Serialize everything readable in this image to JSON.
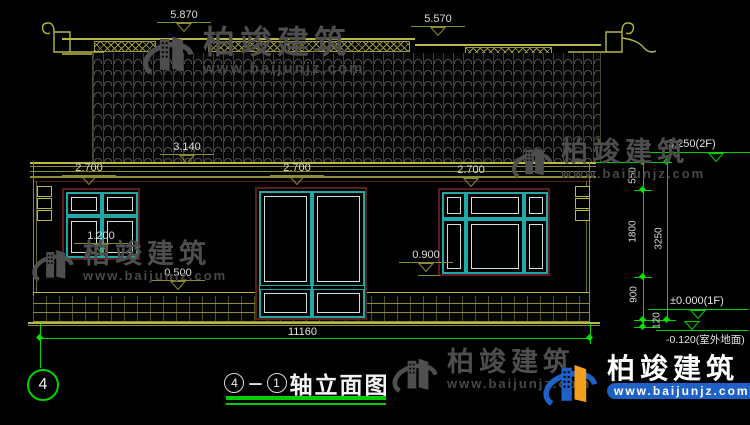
{
  "watermark": {
    "brand": "柏竣建筑",
    "url": "www.baijunjz.com"
  },
  "title_block": {
    "axis_from": "4",
    "separator": "－",
    "axis_to": "1",
    "title": "轴立面图"
  },
  "axis_bubble": "4",
  "levels": {
    "ridge_left": "5.870",
    "ridge_right": "5.570",
    "eave": "3.140",
    "opening_top_left": "2.700",
    "opening_top_center": "2.700",
    "opening_top_right": "2.700",
    "sill_left": "1.200",
    "plinth_top": "0.500",
    "sill_right": "0.900"
  },
  "right_levels": {
    "floor2": "3.250(2F)",
    "floor1": "±0.000(1F)",
    "ground": "-0.120(室外地面)"
  },
  "vertical_dims": {
    "seg_550": "550",
    "seg_1800": "1800",
    "seg_900": "900",
    "seg_120": "120",
    "total": "3250"
  },
  "horizontal_dims": {
    "total_width": "11160"
  },
  "colors": {
    "cad_line": "#8c8c32",
    "cad_line_bright": "#b8b844",
    "dim_green": "#00d400",
    "frame_maroon": "#5a1c1c",
    "lattice_cyan": "#1fa8a8",
    "text_white": "#dcdcdc",
    "brand_blue": "#1e62c8",
    "brand_orange": "#f59f1e",
    "watermark_gray": "#4e4e4e"
  }
}
